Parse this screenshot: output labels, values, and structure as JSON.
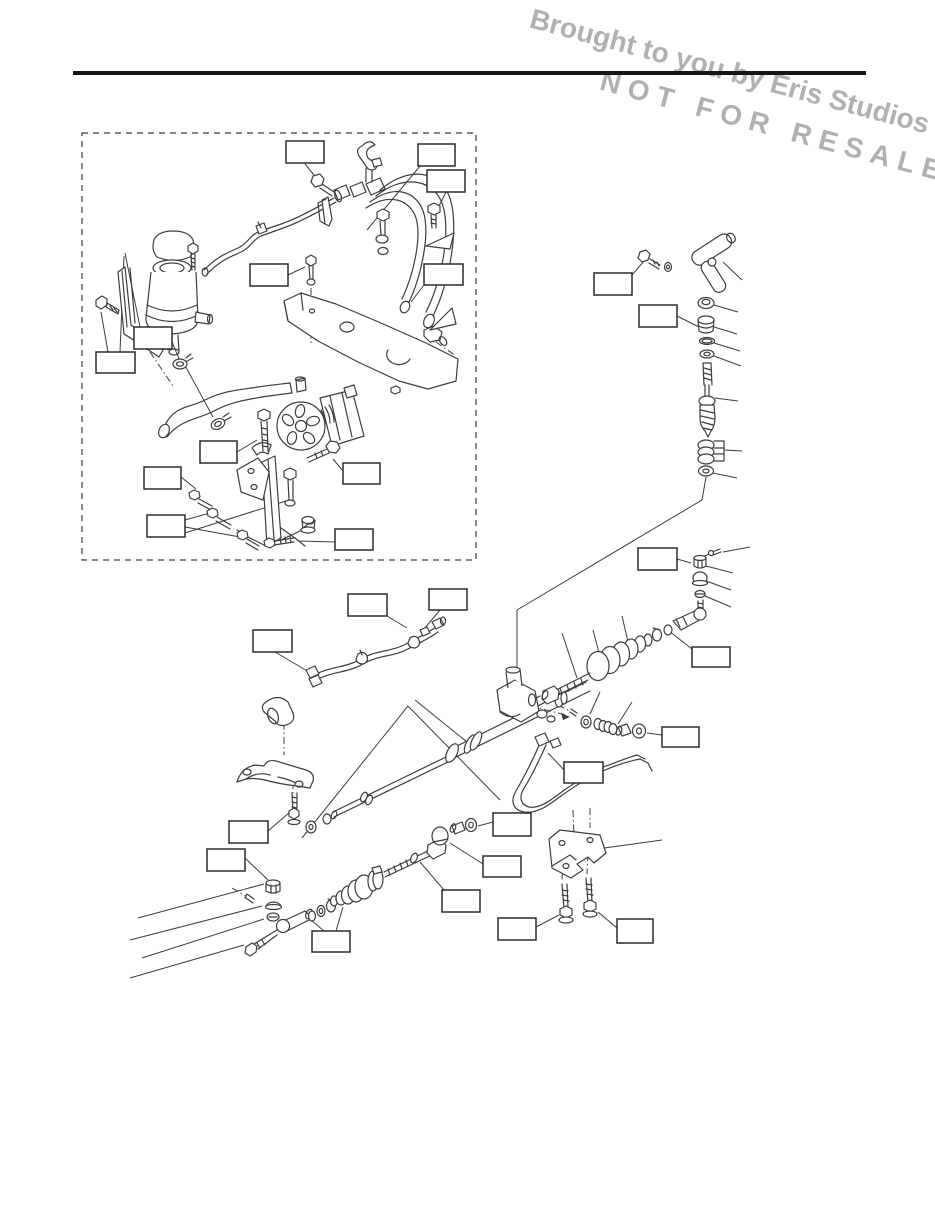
{
  "page": {
    "background": "#ffffff",
    "rule_color": "#161616"
  },
  "watermark": {
    "line1": "Brought to you by Eris Studios",
    "line2": "NOT FOR RESALE",
    "color": "#a3a3a3",
    "rotation_deg": 15
  },
  "diagram": {
    "stroke_color": "#3d3d3d",
    "callout_stroke_color": "#2b2b2b",
    "inset_box": {
      "x": 82,
      "y": 133,
      "w": 394,
      "h": 427
    },
    "callout_boxes": [
      {
        "x": 286,
        "y": 141,
        "w": 38,
        "h": 22
      },
      {
        "x": 418,
        "y": 144,
        "w": 37,
        "h": 22
      },
      {
        "x": 427,
        "y": 170,
        "w": 38,
        "h": 22
      },
      {
        "x": 250,
        "y": 264,
        "w": 38,
        "h": 22
      },
      {
        "x": 424,
        "y": 264,
        "w": 39,
        "h": 21
      },
      {
        "x": 134,
        "y": 327,
        "w": 38,
        "h": 22
      },
      {
        "x": 96,
        "y": 352,
        "w": 39,
        "h": 21
      },
      {
        "x": 200,
        "y": 441,
        "w": 37,
        "h": 22
      },
      {
        "x": 343,
        "y": 463,
        "w": 37,
        "h": 21
      },
      {
        "x": 144,
        "y": 467,
        "w": 37,
        "h": 22
      },
      {
        "x": 147,
        "y": 515,
        "w": 38,
        "h": 22
      },
      {
        "x": 335,
        "y": 529,
        "w": 38,
        "h": 21
      },
      {
        "x": 594,
        "y": 273,
        "w": 38,
        "h": 22
      },
      {
        "x": 639,
        "y": 305,
        "w": 38,
        "h": 22
      },
      {
        "x": 348,
        "y": 594,
        "w": 39,
        "h": 22
      },
      {
        "x": 429,
        "y": 589,
        "w": 38,
        "h": 21
      },
      {
        "x": 253,
        "y": 630,
        "w": 39,
        "h": 22
      },
      {
        "x": 638,
        "y": 548,
        "w": 39,
        "h": 22
      },
      {
        "x": 692,
        "y": 647,
        "w": 38,
        "h": 20
      },
      {
        "x": 662,
        "y": 727,
        "w": 37,
        "h": 20
      },
      {
        "x": 564,
        "y": 762,
        "w": 39,
        "h": 21
      },
      {
        "x": 229,
        "y": 821,
        "w": 39,
        "h": 22
      },
      {
        "x": 207,
        "y": 849,
        "w": 38,
        "h": 22
      },
      {
        "x": 493,
        "y": 813,
        "w": 38,
        "h": 23
      },
      {
        "x": 483,
        "y": 856,
        "w": 38,
        "h": 21
      },
      {
        "x": 442,
        "y": 890,
        "w": 38,
        "h": 22
      },
      {
        "x": 312,
        "y": 931,
        "w": 38,
        "h": 21
      },
      {
        "x": 498,
        "y": 918,
        "w": 38,
        "h": 22
      },
      {
        "x": 617,
        "y": 919,
        "w": 36,
        "h": 24
      }
    ],
    "leader_lines": [
      [
        305,
        164,
        318,
        180
      ],
      [
        420,
        166,
        367,
        230
      ],
      [
        446,
        192,
        437,
        210
      ],
      [
        288,
        275,
        305,
        267
      ],
      [
        424,
        285,
        411,
        302
      ],
      [
        152,
        327,
        168,
        246
      ],
      [
        140,
        327,
        125,
        253
      ],
      [
        172,
        342,
        180,
        361
      ],
      [
        108,
        352,
        101,
        312
      ],
      [
        120,
        352,
        124,
        256
      ],
      [
        237,
        452,
        257,
        440
      ],
      [
        343,
        471,
        333,
        459
      ],
      [
        181,
        477,
        196,
        489
      ],
      [
        185,
        520,
        210,
        513
      ],
      [
        185,
        527,
        240,
        537
      ],
      [
        185,
        533,
        286,
        501
      ],
      [
        335,
        542,
        298,
        541
      ],
      [
        632,
        275,
        644,
        261
      ],
      [
        677,
        316,
        699,
        327
      ],
      [
        387,
        616,
        407,
        628
      ],
      [
        440,
        610,
        424,
        629
      ],
      [
        275,
        652,
        309,
        672
      ],
      [
        677,
        559,
        691,
        563
      ],
      [
        692,
        649,
        669,
        631
      ],
      [
        662,
        735,
        647,
        733
      ],
      [
        565,
        771,
        548,
        753
      ],
      [
        268,
        831,
        290,
        812
      ],
      [
        245,
        858,
        268,
        880
      ],
      [
        493,
        822,
        478,
        826
      ],
      [
        483,
        864,
        450,
        843
      ],
      [
        444,
        890,
        420,
        862
      ],
      [
        324,
        931,
        311,
        920
      ],
      [
        336,
        931,
        343,
        907
      ],
      [
        536,
        927,
        559,
        915
      ],
      [
        617,
        928,
        598,
        912
      ],
      [
        604,
        848,
        662,
        840
      ],
      [
        723,
        262,
        742,
        280
      ],
      [
        714,
        305,
        738,
        312
      ],
      [
        714,
        327,
        737,
        334
      ],
      [
        714,
        343,
        740,
        351
      ],
      [
        714,
        356,
        741,
        366
      ],
      [
        715,
        398,
        738,
        401
      ],
      [
        724,
        450,
        742,
        451
      ],
      [
        713,
        473,
        737,
        478
      ],
      [
        706,
        566,
        733,
        573
      ],
      [
        706,
        581,
        731,
        590
      ],
      [
        705,
        596,
        731,
        607
      ],
      [
        723,
        552,
        750,
        547
      ],
      [
        562,
        633,
        577,
        678
      ],
      [
        593,
        630,
        603,
        668
      ],
      [
        622,
        616,
        631,
        655
      ],
      [
        590,
        714,
        600,
        692
      ],
      [
        618,
        724,
        632,
        702
      ],
      [
        264,
        884,
        138,
        918
      ],
      [
        262,
        906,
        130,
        940
      ],
      [
        264,
        919,
        142,
        958
      ],
      [
        244,
        945,
        130,
        978
      ],
      [
        182,
        360,
        213,
        417
      ],
      [
        415,
        700,
        467,
        742
      ],
      [
        706,
        477,
        702,
        500
      ],
      [
        702,
        500,
        517,
        610
      ],
      [
        517,
        610,
        517,
        695
      ],
      [
        408,
        706,
        302,
        838
      ],
      [
        408,
        706,
        500,
        800
      ]
    ],
    "dash_dot_lines": [
      [
        311,
        288,
        311,
        345
      ],
      [
        150,
        352,
        173,
        386
      ],
      [
        284,
        708,
        284,
        755
      ],
      [
        293,
        782,
        293,
        793
      ],
      [
        563,
        858,
        562,
        880
      ],
      [
        588,
        854,
        587,
        874
      ],
      [
        573,
        810,
        574,
        836
      ],
      [
        590,
        808,
        590,
        828
      ],
      [
        232,
        888,
        246,
        896
      ],
      [
        703,
        557,
        711,
        553
      ],
      [
        558,
        705,
        570,
        711
      ],
      [
        530,
        706,
        566,
        715
      ],
      [
        436,
        342,
        456,
        356
      ]
    ]
  }
}
